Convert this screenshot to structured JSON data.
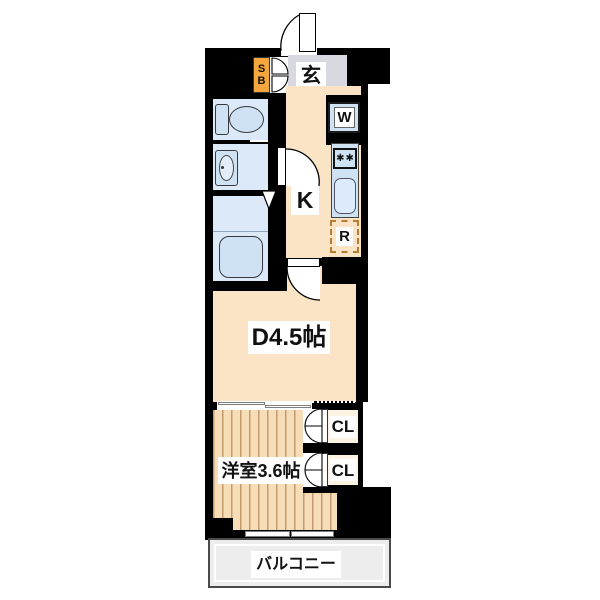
{
  "floorplan": {
    "entrance": {
      "label": "玄",
      "shoe_box_top": "S",
      "shoe_box_bottom": "B"
    },
    "kitchen": {
      "label": "K",
      "washer_label": "W",
      "fridge_label": "R",
      "stove_burner_symbol": "✱"
    },
    "dining": {
      "label": "D4.5帖"
    },
    "western_room": {
      "label": "洋室3.6帖"
    },
    "closets": [
      {
        "label": "CL"
      },
      {
        "label": "CL"
      }
    ],
    "balcony": {
      "label": "バルコニー"
    },
    "colors": {
      "wall": "#000000",
      "room_beige": "#fbe4c6",
      "wet_area_blue": "#dbe9f8",
      "fixture_blue": "#cfe2f4",
      "entrance_gray": "#d8d8e0",
      "shoe_box_orange": "#f6a63e",
      "fridge_dash": "#b97b2e",
      "balcony_gray": "#ededed",
      "wood_stripe": "#c39b6e"
    }
  }
}
